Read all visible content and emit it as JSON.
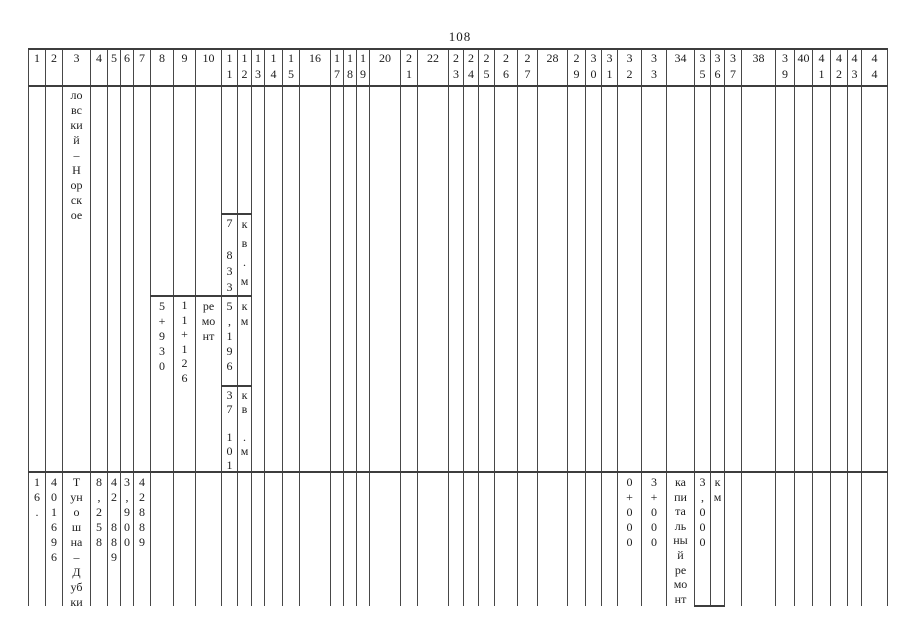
{
  "page_number": "108",
  "table": {
    "header": [
      [
        "1"
      ],
      [
        "2"
      ],
      [
        "3"
      ],
      [
        "4"
      ],
      [
        "5"
      ],
      [
        "6"
      ],
      [
        "7"
      ],
      [
        "8"
      ],
      [
        "9"
      ],
      [
        "10"
      ],
      [
        "1",
        "1"
      ],
      [
        "1",
        "2"
      ],
      [
        "1",
        "3"
      ],
      [
        "1",
        "4"
      ],
      [
        "1",
        "5"
      ],
      [
        "16"
      ],
      [
        "1",
        "7"
      ],
      [
        "1",
        "8"
      ],
      [
        "1",
        "9"
      ],
      [
        "20"
      ],
      [
        "2",
        "1"
      ],
      [
        "22"
      ],
      [
        "2",
        "3"
      ],
      [
        "2",
        "4"
      ],
      [
        "2",
        "5"
      ],
      [
        "2",
        "6"
      ],
      [
        "2",
        "7"
      ],
      [
        "28"
      ],
      [
        "2",
        "9"
      ],
      [
        "3",
        "0"
      ],
      [
        "3",
        "1"
      ],
      [
        "3",
        "2"
      ],
      [
        "3",
        "3"
      ],
      [
        "34"
      ],
      [
        "3",
        "5"
      ],
      [
        "3",
        "6"
      ],
      [
        "3",
        "7"
      ],
      [
        "38"
      ],
      [
        "3",
        "9"
      ],
      [
        "40"
      ],
      [
        "4",
        "1"
      ],
      [
        "4",
        "2"
      ],
      [
        "4",
        "3"
      ],
      [
        "4",
        "4"
      ]
    ],
    "row1": {
      "name_continuation": [
        "ло",
        "вс",
        "ки",
        "й",
        "–",
        "Н",
        "ор",
        "ск",
        "ое"
      ],
      "area_top": [
        "7",
        "",
        "8",
        "3",
        "3"
      ],
      "area_top_unit": [
        "к",
        "в",
        ".",
        "м"
      ],
      "km_from": [
        "5",
        "+",
        "9",
        "3",
        "0"
      ],
      "km_to": [
        "1",
        "1",
        "+",
        "1",
        "2",
        "6"
      ],
      "work_type": [
        "ре",
        "мо",
        "нт"
      ],
      "length_km": [
        "5",
        ",",
        "1",
        "9",
        "6"
      ],
      "length_unit": [
        "к",
        "м"
      ],
      "area_bottom": [
        "3",
        "7",
        "",
        "1",
        "0",
        "1"
      ],
      "area_bottom_unit": [
        "к",
        "в",
        "",
        ".",
        "м"
      ]
    },
    "row2": {
      "row_no": [
        "1",
        "6",
        "."
      ],
      "code": [
        "4",
        "0",
        "1",
        "6",
        "9",
        "6"
      ],
      "name": [
        "Т",
        "ун",
        "о",
        "ш",
        "на",
        "–",
        "Д",
        "уб",
        "ки"
      ],
      "col4": [
        "8",
        ",",
        "2",
        "5",
        "8"
      ],
      "col5": [
        "4",
        "2",
        "",
        "8",
        "8",
        "9"
      ],
      "col6": [
        "3",
        ",",
        "9",
        "0",
        "0"
      ],
      "col7": [
        "4",
        "2",
        "8",
        "8",
        "9"
      ],
      "km_from": [
        "0",
        "+",
        "0",
        "0",
        "0"
      ],
      "km_to": [
        "3",
        "+",
        "0",
        "0",
        "0"
      ],
      "work_type": [
        "ка",
        "пи",
        "та",
        "ль",
        "ны",
        "й",
        "ре",
        "мо",
        "нт"
      ],
      "length": [
        "3",
        ",",
        "0",
        "0",
        "0"
      ],
      "length_unit": [
        "к",
        "м"
      ]
    }
  }
}
